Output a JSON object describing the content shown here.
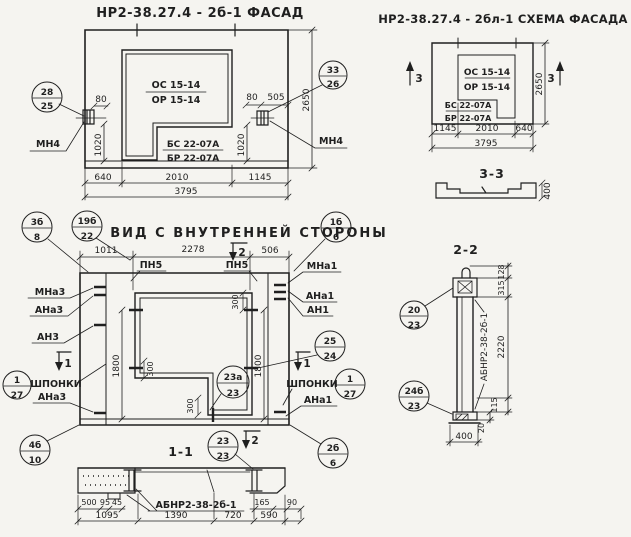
{
  "colors": {
    "ink": "#1f1f1f",
    "paper": "#f5f4f0"
  },
  "facade": {
    "title": "НР2-38.27.4 - 2б-1 ФАСАД",
    "window_mark": {
      "top": "ОС 15-14",
      "bottom": "ОР 15-14"
    },
    "sill_mark": {
      "top": "БС 22-07А",
      "bottom": "БР 22-07А"
    },
    "anchor_label_left": "МН4",
    "anchor_label_right": "МН4",
    "callout_left": {
      "num": "28",
      "sheet": "25"
    },
    "callout_right": {
      "num": "33",
      "sheet": "26"
    },
    "dims": {
      "d80l": "80",
      "d1020l": "1020",
      "d80r": "80",
      "d505": "505",
      "d1020r": "1020",
      "d2650": "2650",
      "d640": "640",
      "d2010": "2010",
      "d1145": "1145",
      "d3795": "3795"
    }
  },
  "scheme": {
    "title": "НР2-38.27.4 - 2бл-1 СХЕМА ФАСАДА",
    "window_mark": {
      "top": "ОС 15-14",
      "bottom": "ОР 15-14"
    },
    "sill_mark": {
      "top": "БС 22-07А",
      "bottom": "БР 22-07А"
    },
    "marker_left": "3",
    "marker_right": "3",
    "dims": {
      "d2650": "2650",
      "d1145": "1145",
      "d2010": "2010",
      "d640": "640",
      "d3795": "3795"
    },
    "section_3_3": {
      "label": "3-3",
      "d400": "400"
    }
  },
  "inner_view": {
    "title": "ВИД С ВНУТРЕННЕЙ СТОРОНЫ",
    "callouts": {
      "c3b_8": {
        "num": "3б",
        "sheet": "8"
      },
      "c19b_22": {
        "num": "19б",
        "sheet": "22"
      },
      "c1b_6": {
        "num": "1б",
        "sheet": "6"
      },
      "c25_24": {
        "num": "25",
        "sheet": "24"
      },
      "c1_27_right": {
        "num": "1",
        "sheet": "27"
      },
      "c1_27_left": {
        "num": "1",
        "sheet": "27"
      },
      "c23a_23": {
        "num": "23а",
        "sheet": "23"
      },
      "c2b_6": {
        "num": "2б",
        "sheet": "6"
      },
      "c4b_10": {
        "num": "4б",
        "sheet": "10"
      }
    },
    "labels": {
      "pn5_left": "ПН5",
      "pn5_right": "ПН5",
      "mna1": "МНа1",
      "ana1": "АНа1",
      "an1": "АН1",
      "ana1_2": "АНа1",
      "mna3": "МНа3",
      "ana3": "АНа3",
      "an3": "АН3",
      "ana3_2": "АНа3",
      "shponki_left": "ШПОНКИ",
      "shponki_right": "ШПОНКИ"
    },
    "markers": {
      "m2_top": "2",
      "m2_bottom": "2",
      "m1_left": "1",
      "m1_right": "1"
    },
    "dims": {
      "d1011": "1011",
      "d2278": "2278",
      "d506": "506",
      "d1800l": "1800",
      "d1800r": "1800",
      "d300a": "300",
      "d300b": "300",
      "d300c": "300"
    }
  },
  "section_1_1": {
    "label": "1-1",
    "beam_mark": "АБНР2-38-2б-1",
    "callout": {
      "num": "23",
      "sheet": "23"
    },
    "dims": {
      "d500": "500",
      "d95": "95",
      "d45": "45",
      "d165": "165",
      "d90": "90",
      "d1095": "1095",
      "d1390": "1390",
      "d720": "720",
      "d590": "590"
    }
  },
  "section_2_2": {
    "label": "2-2",
    "beam_mark": "АБНР2-38-2б-1",
    "callout_top": {
      "num": "20",
      "sheet": "23"
    },
    "callout_bottom": {
      "num": "24б",
      "sheet": "23"
    },
    "dims": {
      "d128": "128",
      "d315": "315",
      "d2220": "2220",
      "d115": "115",
      "d20": "20",
      "d400": "400"
    }
  }
}
